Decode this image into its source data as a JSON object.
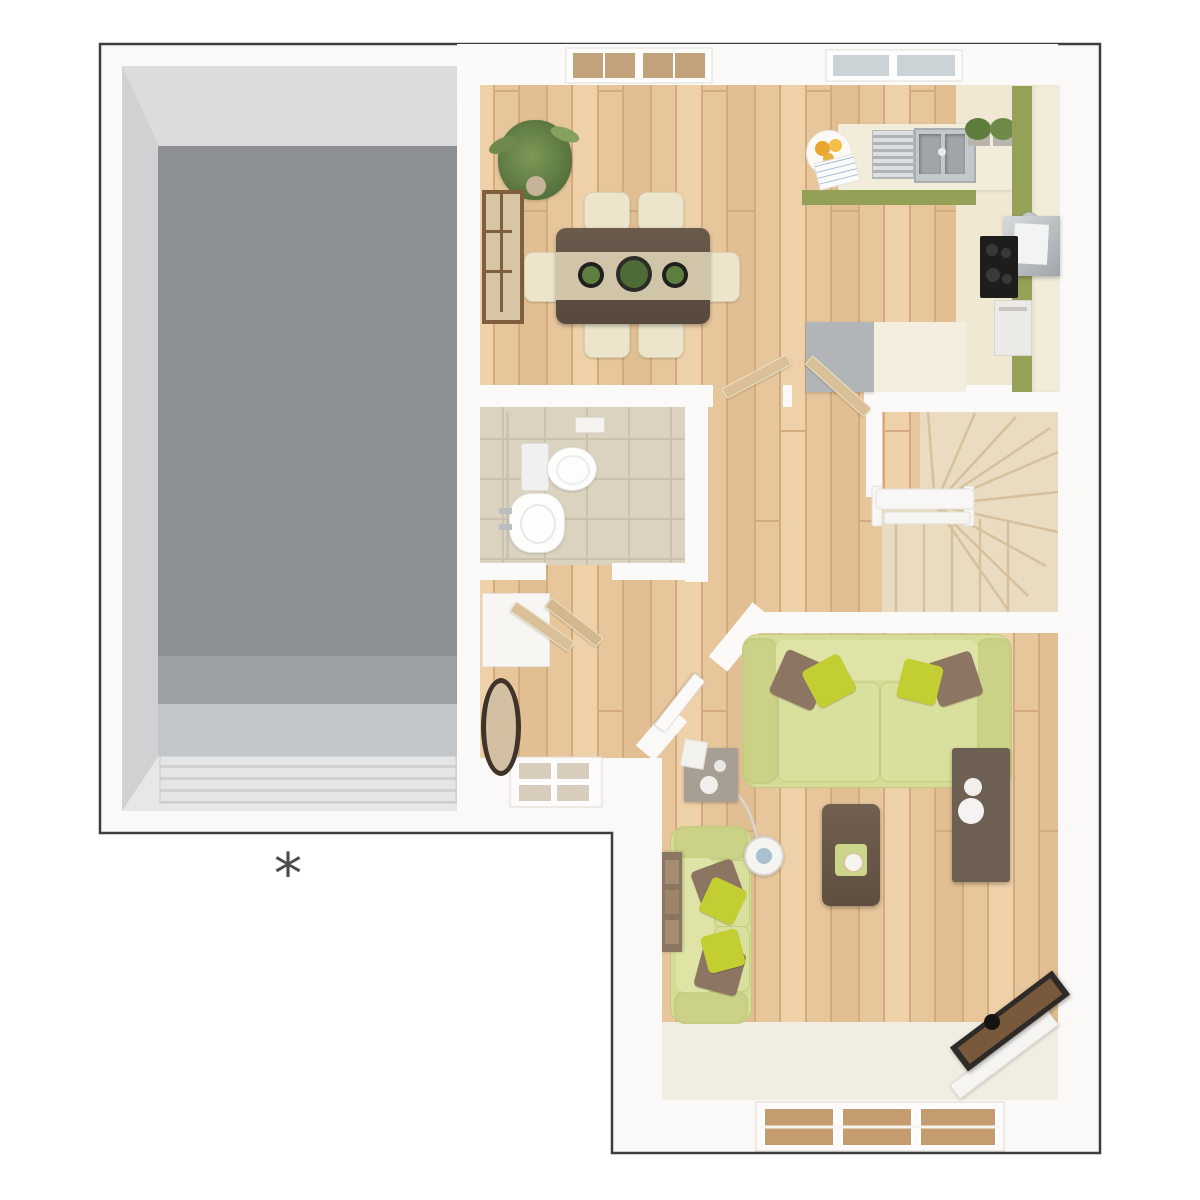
{
  "annotation": {
    "symbol": "*"
  },
  "floor_plan": {
    "style": "3d-render-top-down",
    "rooms": [
      {
        "id": "garage",
        "floor": "grey-concrete",
        "features": [
          "garage-door"
        ]
      },
      {
        "id": "kitchen-dining",
        "floor": "light-oak-plank",
        "features": [
          "french-doors",
          "kitchen-window",
          "worktop",
          "sink",
          "draining-rack",
          "fruit-plate",
          "herb-pots",
          "hob",
          "extractor-hood",
          "oven",
          "island-unit",
          "dining-table",
          "table-runner",
          "three-planters",
          "six-chairs",
          "palm-plant",
          "panel-mirror"
        ]
      },
      {
        "id": "cloakroom-wc",
        "floor": "beige-tile",
        "features": [
          "toilet",
          "basin",
          "glass-screen",
          "shelf"
        ]
      },
      {
        "id": "hall",
        "floor": "light-oak-plank",
        "features": [
          "front-door",
          "oval-mirror",
          "storage-cupboard",
          "open-doors"
        ]
      },
      {
        "id": "stairs",
        "floor": "beige-carpet",
        "features": [
          "winder-steps",
          "straight-steps",
          "handrail"
        ]
      },
      {
        "id": "living-room",
        "floor": "light-oak-plank",
        "features": [
          "sofa-top",
          "sofa-left",
          "coffee-table",
          "tray-candle",
          "side-table",
          "floor-lamp",
          "media-sideboard",
          "drawer-chest",
          "three-picture-frames",
          "corner-tv",
          "rear-window"
        ]
      }
    ]
  },
  "palette": {
    "outline": "#3e3e3e",
    "wall": "#fbfaf8",
    "garage_floor": "#8d9092",
    "wood_floor": "#e7c69b",
    "wc_tile": "#dbd2c0",
    "stair_carpet": "#eadcc0",
    "kitchen_tile": "#f0e8d3",
    "cabinet_green": "#95a157",
    "counter_cream": "#f2ecda",
    "sofa_green": "#d6dc97",
    "pillow_yellow": "#c2ce32",
    "cushion_brown": "#8d7564",
    "dark_wood": "#6b5b4d",
    "annotation_grey": "#4c4c4c"
  }
}
